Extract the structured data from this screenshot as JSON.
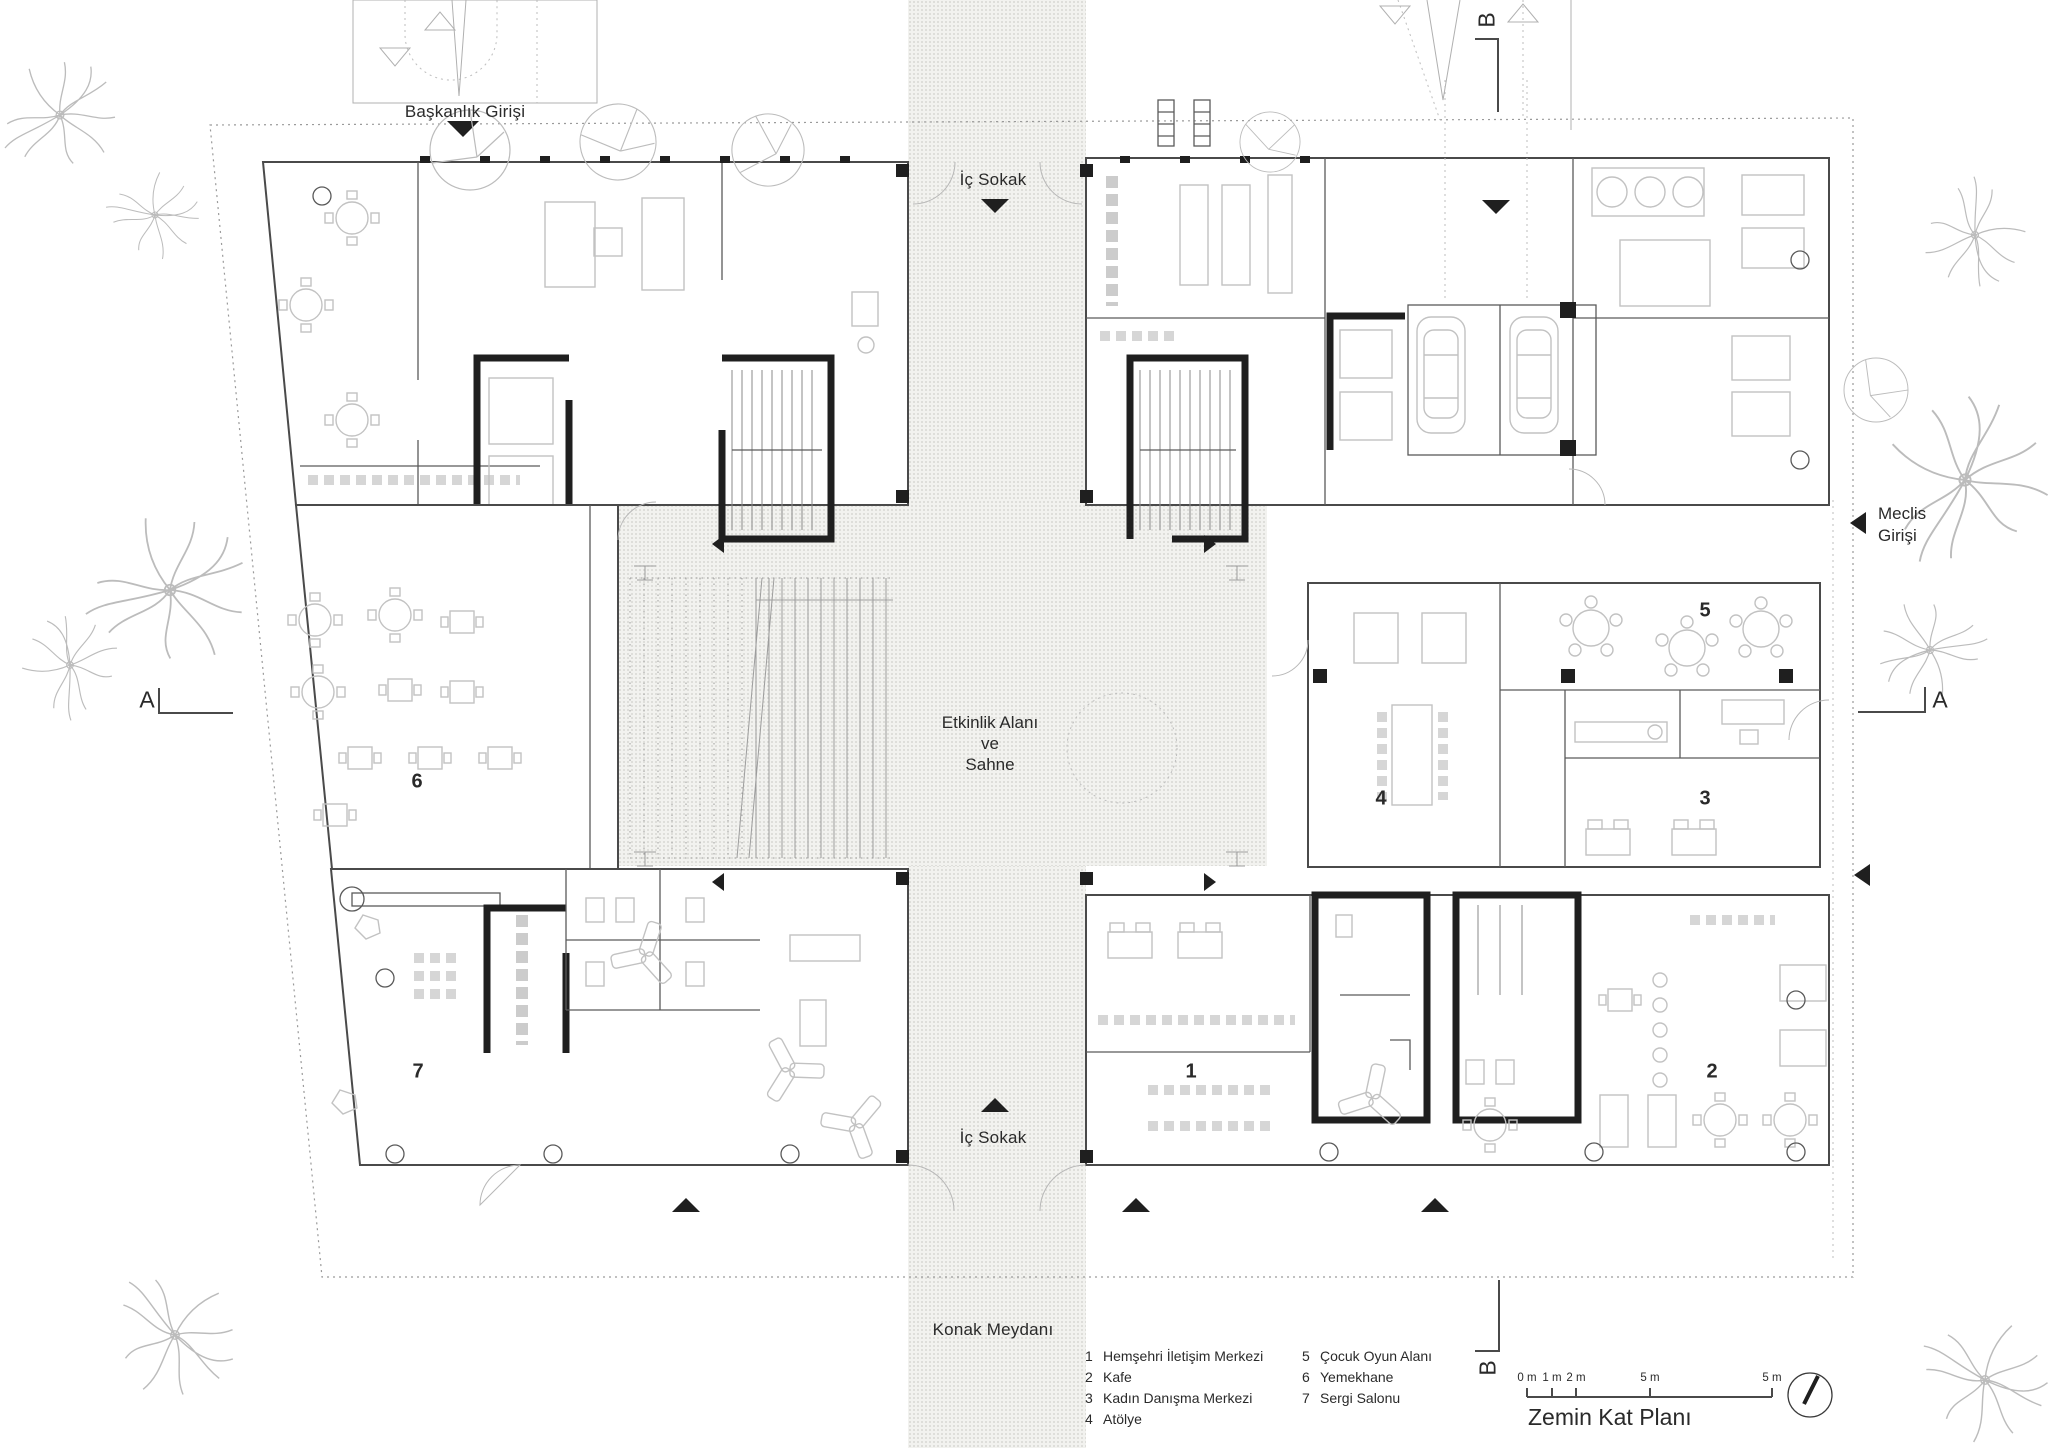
{
  "title": "Zemin Kat Planı",
  "labels": {
    "baskanlik_girisi": "Başkanlık Girişi",
    "ic_sokak_top": "İç Sokak",
    "ic_sokak_bottom": "İç Sokak",
    "konak_meydani": "Konak Meydanı",
    "meclis_line1": "Meclis",
    "meclis_line2": "Girişi",
    "etkinlik_line1": "Etkinlik Alanı",
    "etkinlik_line2": "ve",
    "etkinlik_line3": "Sahne"
  },
  "section_markers": {
    "a": "A",
    "b": "B"
  },
  "rooms": [
    {
      "number": "1",
      "name": "Hemşehri İletişim Merkezi"
    },
    {
      "number": "2",
      "name": "Kafe"
    },
    {
      "number": "3",
      "name": "Kadın Danışma Merkezi"
    },
    {
      "number": "4",
      "name": "Atölye"
    },
    {
      "number": "5",
      "name": "Çocuk Oyun Alanı"
    },
    {
      "number": "6",
      "name": "Yemekhane"
    },
    {
      "number": "7",
      "name": "Sergi Salonu"
    }
  ],
  "scale_bar": {
    "labels": [
      "0 m",
      "1 m",
      "2 m",
      "5 m",
      "5 m"
    ]
  },
  "colors": {
    "ink": "#2a2a2a",
    "wall": "#4a4a4a",
    "core": "#1f1f1f",
    "furniture": "#c8c8c8",
    "stipple_bg": "#f2f2ef",
    "boundary": "#9a9a9a"
  }
}
